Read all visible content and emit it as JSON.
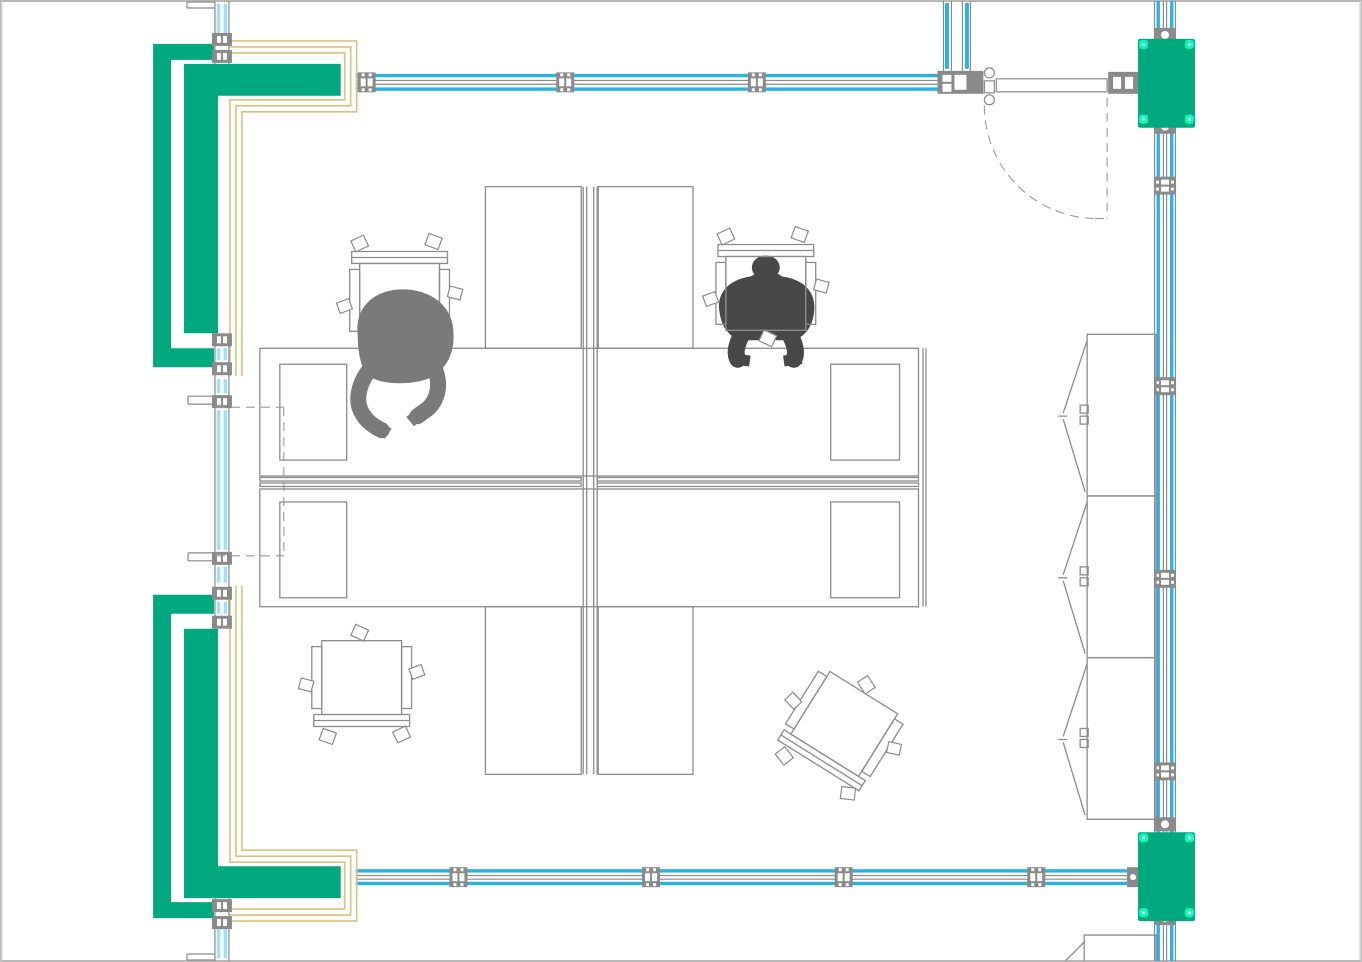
{
  "document": {
    "title": "Office floor plan CAD drawing, top-down plan view",
    "visible_text": []
  },
  "colors": {
    "background": "#ffffff",
    "border": "#b8b8b8",
    "green": "#00a87e",
    "tick": "#00ffb9",
    "blue": "#29b2e8",
    "glass": "#a5dff7",
    "yellow": "#d9c27d",
    "wall": "#8a8a8a",
    "furn": "#8c8c8c",
    "person1": "#7a7a7a",
    "person2": "#484848",
    "dash": "#9a9a9a"
  },
  "elements": {
    "walls": {
      "top": "glazed curtain wall band with mullions",
      "bottom": "glazed curtain wall band with mullions",
      "right": "vertical glazed curtain wall with mullions",
      "left": "glazed wall segments between corner service shafts"
    },
    "door": {
      "type": "single swing door",
      "location": "top right",
      "swing": "dashed quarter-circle arc"
    },
    "service_shafts": {
      "count": 2,
      "location": "left side corners",
      "finish": "green fill with tan trim lines"
    },
    "wall_blocks": {
      "count": 2,
      "location": "right wall",
      "finish": "green fill with bright corner markers"
    },
    "workstation_cluster": {
      "desks": 2,
      "desk_inset_panels": 4,
      "privacy_screens": 4,
      "center_spine": "double partition"
    },
    "chairs": {
      "count": 4,
      "occupied": 2,
      "empty": 2
    },
    "people": {
      "count": 2,
      "pose": "seated, leaning over desks"
    },
    "cabinets": {
      "count": 3,
      "style": "open-door units",
      "location": "along right wall",
      "partial_units": 1
    },
    "utility": {
      "dashed_service_lines": "from left wall to desk cluster"
    }
  }
}
